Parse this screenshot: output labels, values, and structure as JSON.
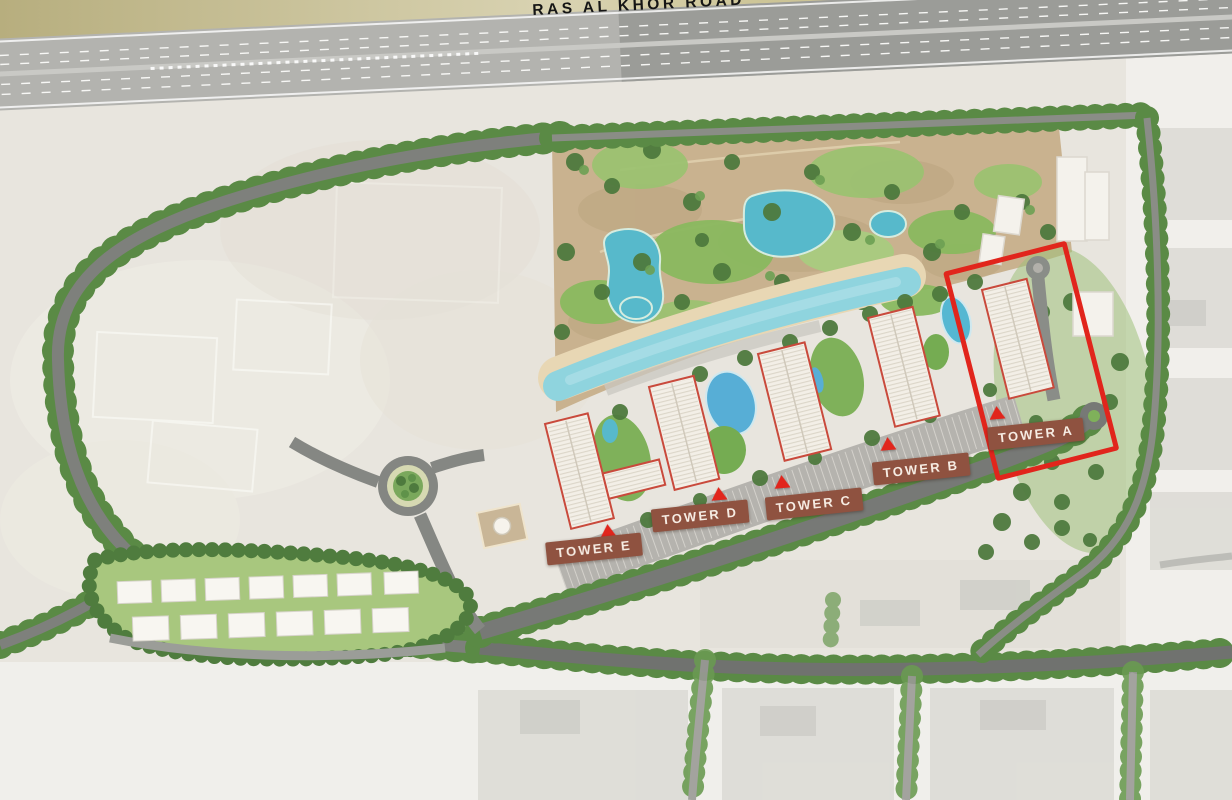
{
  "map": {
    "title": "Development masterplan aerial site map",
    "highway_label": "RAS AL KHOR ROAD",
    "towers": [
      {
        "id": "a",
        "label": "TOWER A",
        "highlighted": true
      },
      {
        "id": "b",
        "label": "TOWER B",
        "highlighted": false
      },
      {
        "id": "c",
        "label": "TOWER C",
        "highlighted": false
      },
      {
        "id": "d",
        "label": "TOWER D",
        "highlighted": false
      },
      {
        "id": "e",
        "label": "TOWER E",
        "highlighted": false
      }
    ],
    "colors": {
      "accent_red": "#e1251c",
      "tower_outline_red": "#c94a3c",
      "label_background": "#8f5240",
      "label_text": "#f6ece3",
      "desert_beige": "#e8e5de",
      "park_sand": "#c9b28f",
      "lawn_green": "#7fb15a",
      "tree_green": "#55823f",
      "pond_teal": "#57b9cb",
      "lagoon_blue": "#8fd4de",
      "pool_blue": "#57aed6",
      "road_gray": "#777976",
      "highway_gray": "#b3b3af",
      "olive_verge": "#bcb383",
      "faded_city": "#f0efeb"
    }
  }
}
